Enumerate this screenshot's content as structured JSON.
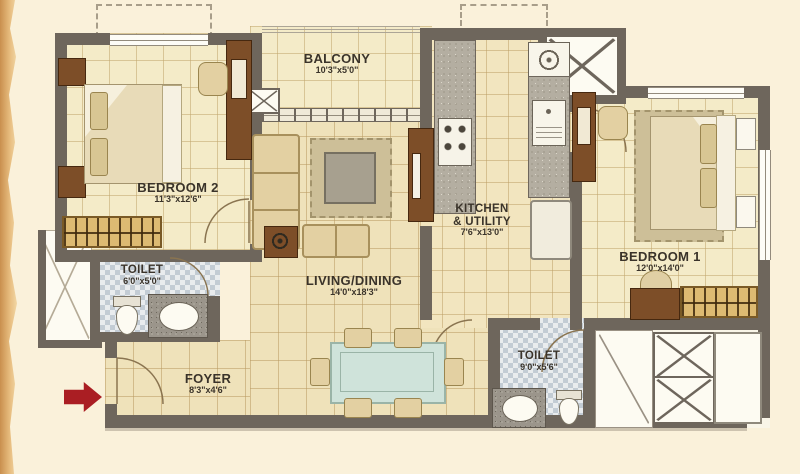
{
  "title": "apartment-floor-plan",
  "colors": {
    "background": "#faf1da",
    "wall": "#6e665c",
    "floor_bedroom": "#f4ebc8",
    "floor_living": "#efe2ba",
    "floor_kitchen": "#f2e5bf",
    "bathroom_tile": "#c3ccd4",
    "wood_dark": "#7d4e28",
    "wardrobe_tan": "#ddba72",
    "rug": "#cdbf98",
    "dining_glass": "#cfe3da",
    "entrance_arrow": "#aa1e23",
    "label_text": "#3a332a"
  },
  "icons": {
    "entrance_arrow": "right-arrow",
    "shaft_marker": "x-cross",
    "wardrobe_marker": "hanger-rail"
  },
  "rooms": {
    "balcony": {
      "name": "BALCONY",
      "dims": "10'3\"x5'0\""
    },
    "bedroom2": {
      "name": "BEDROOM 2",
      "dims": "11'3\"x12'6\""
    },
    "toilet1": {
      "name": "TOILET",
      "dims": "6'0\"x5'0\""
    },
    "living": {
      "name": "LIVING/DINING",
      "dims": "14'0\"x18'3\""
    },
    "kitchen": {
      "name": "KITCHEN",
      "name2": "& UTILITY",
      "dims": "7'6\"x13'0\""
    },
    "bedroom1": {
      "name": "BEDROOM 1",
      "dims": "12'0\"x14'0\""
    },
    "toilet2": {
      "name": "TOILET",
      "dims": "9'0\"x5'6\""
    },
    "foyer": {
      "name": "FOYER",
      "dims": "8'3\"x4'6\""
    }
  }
}
